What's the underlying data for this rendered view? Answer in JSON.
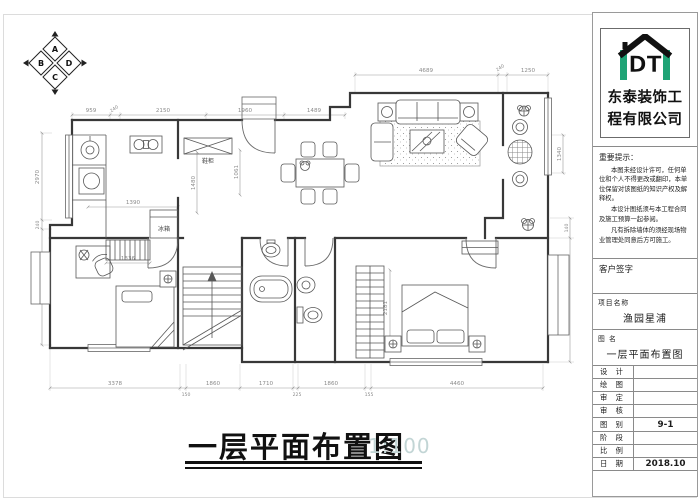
{
  "compass": {
    "top": "A",
    "right": "D",
    "bottom": "C",
    "left": "B"
  },
  "drawing_title": {
    "text": "一层平面布置图",
    "scale": "1:100"
  },
  "plan": {
    "labels": {
      "fridge": "冰箱",
      "shoe_cabinet": "鞋柜"
    },
    "dims": {
      "top_left": [
        "959",
        "240",
        "2150",
        "1960",
        "1489"
      ],
      "top_right": [
        "4689",
        "240",
        "1250"
      ],
      "left": [
        "2970",
        "240",
        "2745"
      ],
      "right": [
        "1340",
        "140",
        "3770"
      ],
      "bottom": [
        "3378",
        "150",
        "1860",
        "1710",
        "225",
        "1860",
        "155",
        "4460"
      ],
      "interior": {
        "kitchen": "1390",
        "wardrobe": "1336",
        "hall_v": "1480",
        "entry_v": "1061",
        "master_wardrobe_v": "2181"
      }
    }
  },
  "title_block": {
    "company": {
      "logo_text": "DT",
      "name_line1": "东泰装饰工",
      "name_line2": "程有限公司",
      "accent_color": "#1fa476"
    },
    "notice": {
      "heading": "重要提示：",
      "p1": "本图未经设计许可，任何单位和个人不得更改或翻印，本单位保留对该图纸的知识产权及解释权。",
      "p2": "本设计图纸须与本工程合同及施工预算一起参阅。",
      "p3": "凡有拆除墙体的须经现场物业管理处同意后方可施工。"
    },
    "client_sign_label": "客户签字",
    "project": {
      "label": "项目名称",
      "value": "渔园星浦"
    },
    "drawing": {
      "label": "图  名",
      "value": "一层平面布置图"
    },
    "rows": [
      {
        "label": "设 计",
        "value": ""
      },
      {
        "label": "绘 图",
        "value": ""
      },
      {
        "label": "审 定",
        "value": ""
      },
      {
        "label": "审 核",
        "value": ""
      },
      {
        "label": "图 别",
        "value": "9-1"
      },
      {
        "label": "阶 段",
        "value": ""
      },
      {
        "label": "比 例",
        "value": ""
      },
      {
        "label": "日 期",
        "value": "2018.10"
      }
    ]
  }
}
